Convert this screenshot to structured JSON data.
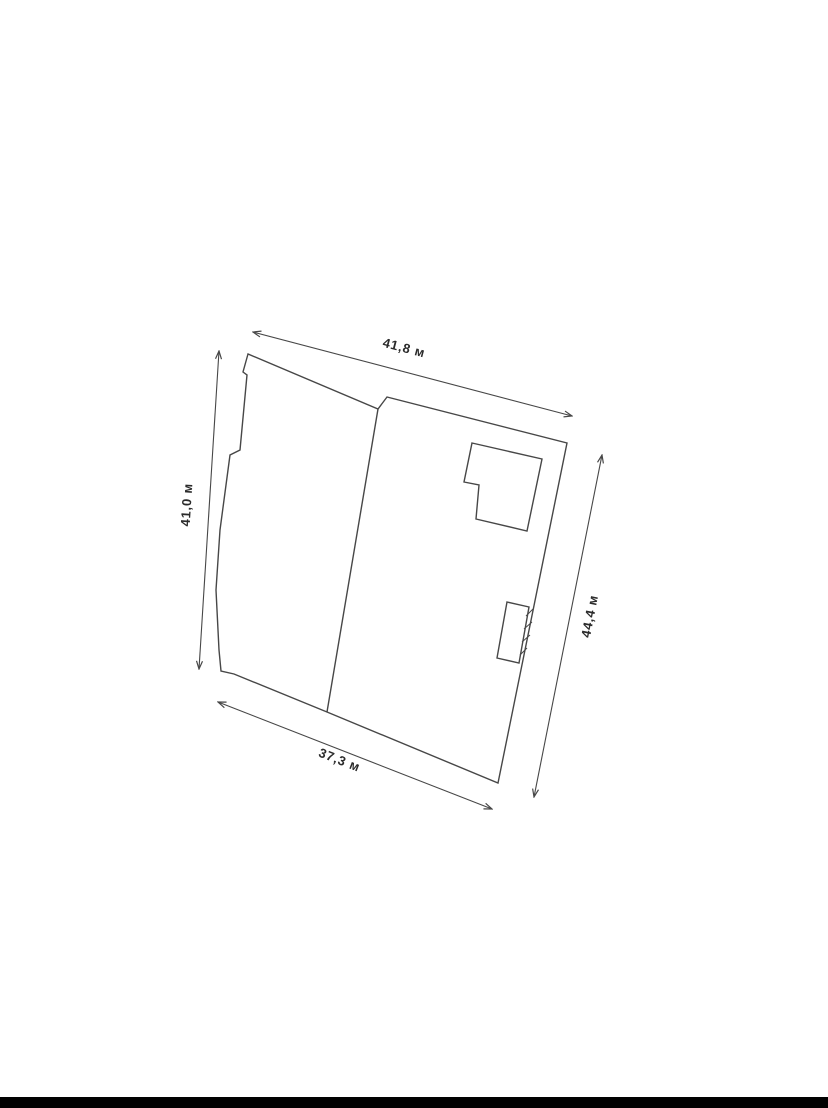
{
  "page": {
    "background_color": "#ffffff",
    "letterbox_bar": {
      "color": "#010101"
    }
  },
  "diagram": {
    "type": "cadastral-site-plan",
    "units": "м",
    "line_color": "#474747",
    "label_color": "#2b2b2b",
    "shapes": [
      {
        "name": "parcel-outline",
        "kind": "polygon",
        "points": [
          [
            248,
            354
          ],
          [
            243,
            372
          ],
          [
            247,
            375
          ],
          [
            240,
            450
          ],
          [
            230,
            455
          ],
          [
            220,
            530
          ],
          [
            216,
            590
          ],
          [
            219,
            650
          ],
          [
            221,
            671
          ],
          [
            234,
            674
          ],
          [
            327,
            712
          ],
          [
            498,
            783
          ],
          [
            567,
            443
          ],
          [
            387,
            397
          ],
          [
            378,
            409
          ]
        ]
      },
      {
        "name": "divider-line",
        "kind": "polyline",
        "points": [
          [
            378,
            409
          ],
          [
            327,
            712
          ]
        ]
      },
      {
        "name": "building-main",
        "kind": "polygon",
        "points": [
          [
            472,
            443
          ],
          [
            542,
            459
          ],
          [
            527,
            531
          ],
          [
            476,
            519
          ],
          [
            479,
            485
          ],
          [
            464,
            482
          ]
        ]
      },
      {
        "name": "building-annex",
        "kind": "polygon",
        "points": [
          [
            507,
            602
          ],
          [
            529,
            607
          ],
          [
            519,
            663
          ],
          [
            497,
            658
          ]
        ]
      },
      {
        "name": "annex-hatch-marks",
        "kind": "segments",
        "segments": [
          [
            [
              526,
              616
            ],
            [
              533,
              609
            ]
          ],
          [
            [
              524,
              629
            ],
            [
              532,
              622
            ]
          ],
          [
            [
              522,
              642
            ],
            [
              530,
              635
            ]
          ],
          [
            [
              520,
              655
            ],
            [
              527,
              648
            ]
          ]
        ]
      }
    ],
    "dimensions": [
      {
        "name": "dimension-top",
        "label": "41,8 м",
        "value_m": 41.8,
        "line": [
          [
            253,
            332
          ],
          [
            572,
            416
          ]
        ],
        "label_pos": [
          403,
          352
        ],
        "label_angle": 14.7
      },
      {
        "name": "dimension-left",
        "label": "41,0 м",
        "value_m": 41.0,
        "line": [
          [
            219,
            351
          ],
          [
            199,
            669
          ]
        ],
        "label_pos": [
          191,
          505
        ],
        "label_angle": -86.4
      },
      {
        "name": "dimension-right",
        "label": "44,4 м",
        "value_m": 44.4,
        "line": [
          [
            602,
            455
          ],
          [
            534,
            797
          ]
        ],
        "label_pos": [
          594,
          617
        ],
        "label_angle": -78.9
      },
      {
        "name": "dimension-bottom",
        "label": "37,3 м",
        "value_m": 37.3,
        "line": [
          [
            218,
            702
          ],
          [
            492,
            809
          ]
        ],
        "label_pos": [
          338,
          764
        ],
        "label_angle": 21.3
      }
    ]
  }
}
